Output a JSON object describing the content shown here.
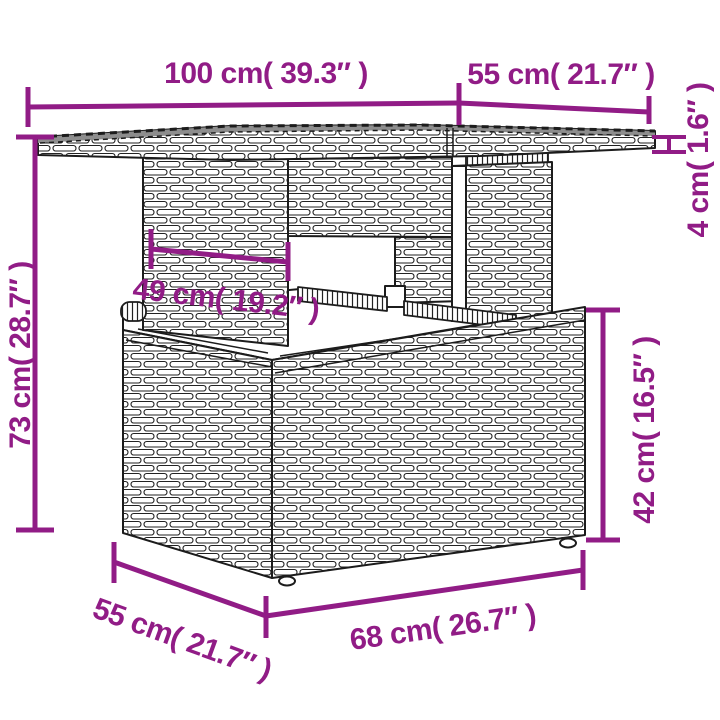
{
  "diagram": {
    "description": "Dimension diagram of a poly rattan garden table with bench stored underneath",
    "accent_color": "#911c86",
    "outline_color": "#1c1c1c",
    "tabletop_band_color": "#8d8d8d",
    "labels": {
      "table_width": "100 cm( 39.3″ )",
      "table_depth": "55 cm( 21.7″ )",
      "tabletop_thickness": "4 cm( 1.6″ )",
      "table_height": "73 cm( 28.7″ )",
      "leg_panel_width": "49 cm( 19.2″ )",
      "bench_height": "42 cm( 16.5″ )",
      "bench_depth": "55 cm( 21.7″ )",
      "bench_width": "68 cm( 26.7″ )"
    }
  }
}
